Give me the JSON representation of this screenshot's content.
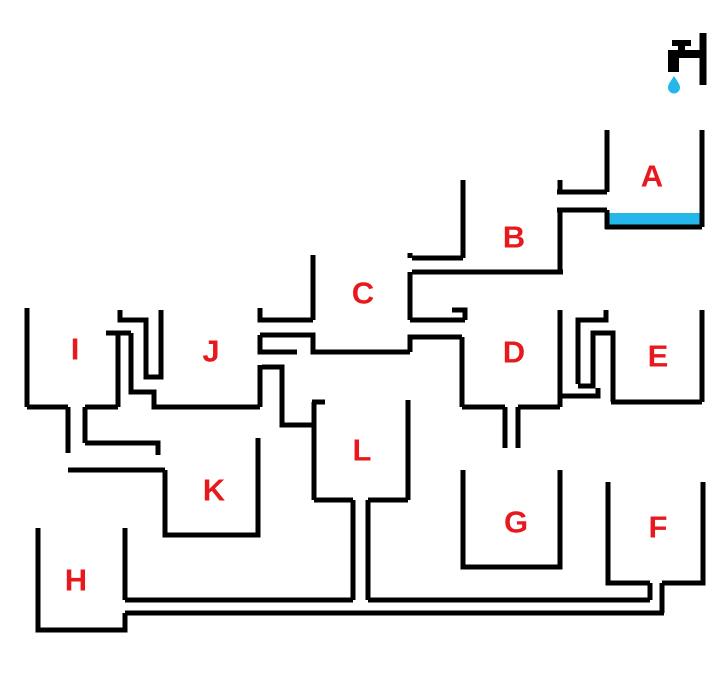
{
  "title": "water-flow-container-puzzle",
  "colors": {
    "background": "#ffffff",
    "ink": "#000000",
    "label_red": "#e8191d",
    "water_blue": "#25b6ea"
  },
  "stroke_width": 5,
  "label_font_size": 31,
  "labels": [
    {
      "id": "A",
      "text": "A",
      "x": 652,
      "y": 176
    },
    {
      "id": "B",
      "text": "B",
      "x": 514,
      "y": 237
    },
    {
      "id": "C",
      "text": "C",
      "x": 363,
      "y": 293
    },
    {
      "id": "D",
      "text": "D",
      "x": 514,
      "y": 352
    },
    {
      "id": "E",
      "text": "E",
      "x": 658,
      "y": 356
    },
    {
      "id": "F",
      "text": "F",
      "x": 658,
      "y": 527
    },
    {
      "id": "G",
      "text": "G",
      "x": 516,
      "y": 522
    },
    {
      "id": "H",
      "text": "H",
      "x": 76,
      "y": 580
    },
    {
      "id": "I",
      "text": "I",
      "x": 75,
      "y": 349
    },
    {
      "id": "J",
      "text": "J",
      "x": 211,
      "y": 351
    },
    {
      "id": "K",
      "text": "K",
      "x": 214,
      "y": 490
    },
    {
      "id": "L",
      "text": "L",
      "x": 362,
      "y": 450
    }
  ],
  "water_level_a": {
    "x": 609,
    "y": 213,
    "w": 91,
    "h": 12
  },
  "faucet": {
    "wall": [
      [
        703,
        33
      ],
      [
        703,
        85
      ]
    ],
    "rects": [
      {
        "name": "faucet-pipe",
        "x": 670,
        "y": 50,
        "w": 33,
        "h": 8
      },
      {
        "name": "faucet-spout",
        "x": 668,
        "y": 50,
        "w": 11,
        "h": 22
      },
      {
        "name": "faucet-handle-stem",
        "x": 678,
        "y": 45,
        "w": 7,
        "h": 6
      },
      {
        "name": "faucet-handle-bar",
        "x": 672,
        "y": 40,
        "w": 19,
        "h": 6
      }
    ],
    "drop_path": "M674 76 C677 81 680 84 680 87.5 A6 6 0 1 1 668 87.5 C668 84 671 81 674 76 Z"
  },
  "walls": [
    [
      [
        607,
        130
      ],
      [
        607,
        192
      ]
    ],
    [
      [
        557,
        192
      ],
      [
        607,
        192
      ]
    ],
    [
      [
        560,
        180
      ],
      [
        560,
        192
      ]
    ],
    [
      [
        557,
        210
      ],
      [
        607,
        210
      ]
    ],
    [
      [
        607,
        210
      ],
      [
        607,
        229
      ]
    ],
    [
      [
        605,
        227
      ],
      [
        702,
        227
      ]
    ],
    [
      [
        702,
        130
      ],
      [
        702,
        227
      ]
    ],
    [
      [
        463,
        180
      ],
      [
        463,
        258
      ]
    ],
    [
      [
        412,
        258
      ],
      [
        463,
        258
      ]
    ],
    [
      [
        412,
        272
      ],
      [
        563,
        272
      ]
    ],
    [
      [
        560,
        210
      ],
      [
        560,
        272
      ]
    ],
    [
      [
        410,
        253
      ],
      [
        410,
        258
      ]
    ],
    [
      [
        410,
        272
      ],
      [
        410,
        320
      ]
    ],
    [
      [
        313,
        255
      ],
      [
        313,
        320
      ]
    ],
    [
      [
        260,
        308
      ],
      [
        260,
        320
      ],
      [
        313,
        320
      ]
    ],
    [
      [
        260,
        335
      ],
      [
        313,
        335
      ],
      [
        313,
        352
      ],
      [
        410,
        352
      ]
    ],
    [
      [
        260,
        335
      ],
      [
        260,
        352
      ],
      [
        297,
        352
      ]
    ],
    [
      [
        410,
        352
      ],
      [
        410,
        337
      ],
      [
        462,
        337
      ]
    ],
    [
      [
        410,
        320
      ],
      [
        465,
        320
      ]
    ],
    [
      [
        452,
        310
      ],
      [
        465,
        310
      ],
      [
        465,
        320
      ]
    ],
    [
      [
        462,
        337
      ],
      [
        462,
        407
      ]
    ],
    [
      [
        462,
        407
      ],
      [
        505,
        407
      ]
    ],
    [
      [
        505,
        407
      ],
      [
        505,
        448
      ]
    ],
    [
      [
        518,
        407
      ],
      [
        518,
        448
      ]
    ],
    [
      [
        518,
        407
      ],
      [
        560,
        407
      ]
    ],
    [
      [
        560,
        310
      ],
      [
        560,
        407
      ]
    ],
    [
      [
        560,
        396
      ],
      [
        598,
        396
      ],
      [
        598,
        388
      ]
    ],
    [
      [
        606,
        310
      ],
      [
        606,
        320
      ],
      [
        578,
        320
      ],
      [
        578,
        384
      ]
    ],
    [
      [
        578,
        386
      ],
      [
        593,
        386
      ],
      [
        593,
        333
      ],
      [
        613,
        333
      ],
      [
        613,
        402
      ]
    ],
    [
      [
        611,
        402
      ],
      [
        702,
        402
      ]
    ],
    [
      [
        702,
        310
      ],
      [
        702,
        402
      ]
    ],
    [
      [
        27,
        308
      ],
      [
        27,
        407
      ]
    ],
    [
      [
        27,
        407
      ],
      [
        68,
        407
      ]
    ],
    [
      [
        68,
        407
      ],
      [
        68,
        453
      ]
    ],
    [
      [
        85,
        407
      ],
      [
        85,
        443
      ]
    ],
    [
      [
        85,
        407
      ],
      [
        118,
        407
      ]
    ],
    [
      [
        118,
        333
      ],
      [
        118,
        407
      ]
    ],
    [
      [
        106,
        333
      ],
      [
        131,
        333
      ]
    ],
    [
      [
        131,
        333
      ],
      [
        131,
        392
      ],
      [
        154,
        392
      ],
      [
        154,
        407
      ],
      [
        260,
        407
      ]
    ],
    [
      [
        120,
        310
      ],
      [
        120,
        320
      ],
      [
        146,
        320
      ],
      [
        146,
        377
      ],
      [
        161,
        377
      ],
      [
        161,
        310
      ]
    ],
    [
      [
        260,
        365
      ],
      [
        260,
        407
      ]
    ],
    [
      [
        262,
        367
      ],
      [
        282,
        367
      ],
      [
        282,
        425
      ],
      [
        314,
        425
      ]
    ],
    [
      [
        312,
        402
      ],
      [
        325,
        402
      ]
    ],
    [
      [
        314,
        402
      ],
      [
        314,
        500
      ]
    ],
    [
      [
        314,
        500
      ],
      [
        353,
        500
      ]
    ],
    [
      [
        353,
        500
      ],
      [
        353,
        600
      ]
    ],
    [
      [
        368,
        500
      ],
      [
        368,
        600
      ]
    ],
    [
      [
        368,
        500
      ],
      [
        408,
        500
      ]
    ],
    [
      [
        408,
        400
      ],
      [
        408,
        500
      ]
    ],
    [
      [
        85,
        443
      ],
      [
        158,
        443
      ],
      [
        158,
        455
      ]
    ],
    [
      [
        68,
        470
      ],
      [
        165,
        470
      ]
    ],
    [
      [
        165,
        470
      ],
      [
        165,
        535
      ],
      [
        258,
        535
      ],
      [
        258,
        438
      ]
    ],
    [
      [
        38,
        528
      ],
      [
        38,
        630
      ],
      [
        125,
        630
      ],
      [
        125,
        613
      ]
    ],
    [
      [
        125,
        528
      ],
      [
        125,
        600
      ]
    ],
    [
      [
        125,
        600
      ],
      [
        353,
        600
      ]
    ],
    [
      [
        368,
        600
      ],
      [
        650,
        600
      ]
    ],
    [
      [
        125,
        613
      ],
      [
        664,
        613
      ]
    ],
    [
      [
        650,
        600
      ],
      [
        650,
        583
      ]
    ],
    [
      [
        662,
        583
      ],
      [
        662,
        613
      ]
    ],
    [
      [
        463,
        470
      ],
      [
        463,
        567
      ],
      [
        560,
        567
      ],
      [
        560,
        470
      ]
    ],
    [
      [
        608,
        482
      ],
      [
        608,
        583
      ],
      [
        650,
        583
      ]
    ],
    [
      [
        662,
        583
      ],
      [
        703,
        583
      ],
      [
        703,
        482
      ]
    ]
  ]
}
